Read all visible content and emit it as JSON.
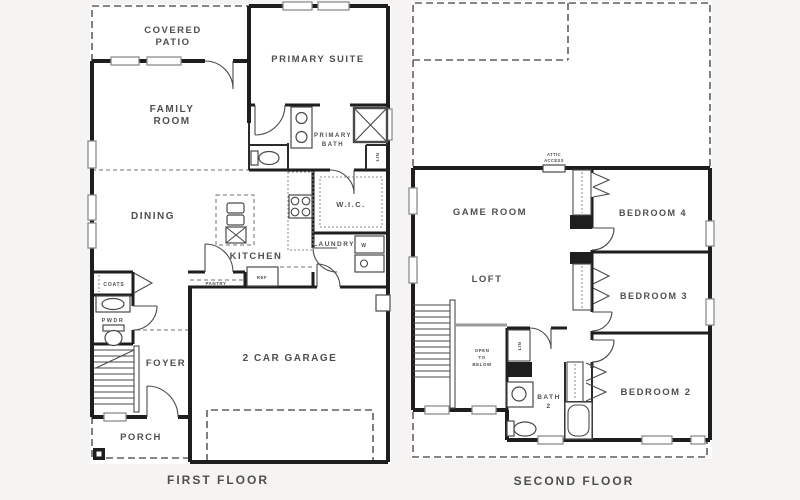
{
  "meta": {
    "background": "#f5f4f2",
    "wall_color": "#1e1e1e",
    "label_color": "#4f4f4f",
    "plan_fill": "#ffffff"
  },
  "first_floor": {
    "title": "FIRST FLOOR",
    "labels": {
      "covered_patio_1": "COVERED",
      "covered_patio_2": "PATIO",
      "primary_suite": "PRIMARY SUITE",
      "family_room_1": "FAMILY",
      "family_room_2": "ROOM",
      "primary_bath_1": "PRIMARY",
      "primary_bath_2": "BATH",
      "linen": "LIN",
      "dining": "DINING",
      "wic": "W.I.C.",
      "kitchen": "KITCHEN",
      "laundry": "LAUNDRY",
      "washer": "W",
      "coats": "COATS",
      "pwdr": "PWDR",
      "pantry": "PANTRY",
      "ref": "REF",
      "foyer": "FOYER",
      "garage": "2 CAR GARAGE",
      "porch": "PORCH"
    }
  },
  "second_floor": {
    "title": "SECOND FLOOR",
    "labels": {
      "attic_1": "ATTIC",
      "attic_2": "ACCESS",
      "game_room": "GAME ROOM",
      "bedroom4": "BEDROOM 4",
      "loft": "LOFT",
      "bedroom3": "BEDROOM 3",
      "open_1": "OPEN",
      "open_2": "TO",
      "open_3": "BELOW",
      "linen": "LIN",
      "bath2_1": "BATH",
      "bath2_2": "2",
      "bedroom2": "BEDROOM 2"
    }
  }
}
